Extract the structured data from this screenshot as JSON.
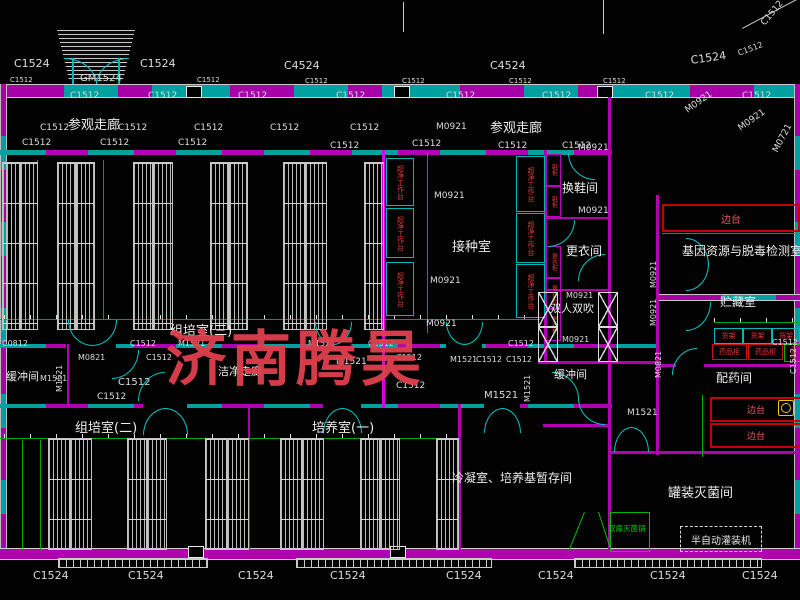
{
  "watermark": {
    "text": "济南腾昊",
    "color": "#e0404e"
  },
  "rooms": {
    "visitor_corridor_left": "参观走廊",
    "visitor_corridor_right": "参观走廊",
    "tissue_culture_3": "组培室(三)",
    "tissue_culture_2": "组培室(二)",
    "culture_1": "培养室(一)",
    "inoculation": "接种室",
    "shoe_change": "换鞋间",
    "clothes_change": "更衣间",
    "air_shower": "双人双吹",
    "gene_lab": "基因资源与脱毒检测室",
    "storage": "贮藏室",
    "dispensary": "配药间",
    "buffer_left": "缓冲间",
    "buffer_right": "缓冲间",
    "clean_corridor": "洁净走廊",
    "condensation": "冷凝室、培养基暂存间",
    "canning": "罐装灭菌间"
  },
  "equipment": {
    "clean_bench": "超净工作台",
    "shoe_cabinet": "鞋柜",
    "clothes_cabinet": "更衣柜",
    "shelf_rack": "货架",
    "medicine_cabinet": "药品柜",
    "sterilizer_pot": "灭菌锅",
    "side_bench": "边台",
    "double_door_sterilizer": "双扉灭菌锅",
    "filling_machine": "半自动灌装机"
  },
  "colors": {
    "wall_magenta": "#b000b0",
    "window_cyan": "#00a0a0",
    "dimension_green": "#00a800",
    "equipment_red": "#d02020",
    "watermark_red": "#e0404e",
    "line_white": "#d0d0d0"
  },
  "annotations": [
    {
      "t": "C1524",
      "x": 14,
      "y": 58,
      "s": 11
    },
    {
      "t": "GM1524",
      "x": 80,
      "y": 74,
      "s": 10
    },
    {
      "t": "C1524",
      "x": 140,
      "y": 58,
      "s": 11
    },
    {
      "t": "C4524",
      "x": 284,
      "y": 60,
      "s": 11
    },
    {
      "t": "C4524",
      "x": 490,
      "y": 60,
      "s": 11
    },
    {
      "t": "C1524",
      "x": 690,
      "y": 55,
      "s": 11,
      "r": -8
    },
    {
      "t": "C1512",
      "x": 737,
      "y": 50,
      "s": 8,
      "r": -20
    },
    {
      "t": "C1512",
      "x": 760,
      "y": 22,
      "s": 9,
      "r": -50
    },
    {
      "t": "C1512",
      "x": 10,
      "y": 77,
      "s": 7
    },
    {
      "t": "C1512",
      "x": 197,
      "y": 77,
      "s": 7
    },
    {
      "t": "C1512",
      "x": 305,
      "y": 78,
      "s": 7
    },
    {
      "t": "C1512",
      "x": 402,
      "y": 78,
      "s": 7
    },
    {
      "t": "C1512",
      "x": 509,
      "y": 78,
      "s": 7
    },
    {
      "t": "C1512",
      "x": 603,
      "y": 78,
      "s": 7
    },
    {
      "t": "C1512",
      "x": 70,
      "y": 92,
      "s": 9
    },
    {
      "t": "C1512",
      "x": 148,
      "y": 92,
      "s": 9
    },
    {
      "t": "C1512",
      "x": 238,
      "y": 92,
      "s": 9
    },
    {
      "t": "C1512",
      "x": 336,
      "y": 92,
      "s": 9
    },
    {
      "t": "C1512",
      "x": 446,
      "y": 92,
      "s": 9
    },
    {
      "t": "C1512",
      "x": 542,
      "y": 92,
      "s": 9
    },
    {
      "t": "C1512",
      "x": 645,
      "y": 92,
      "s": 9
    },
    {
      "t": "C1512",
      "x": 742,
      "y": 92,
      "s": 9
    },
    {
      "t": "C1512",
      "x": 40,
      "y": 124,
      "s": 9
    },
    {
      "t": "C1512",
      "x": 118,
      "y": 124,
      "s": 9
    },
    {
      "t": "C1512",
      "x": 194,
      "y": 124,
      "s": 9
    },
    {
      "t": "C1512",
      "x": 270,
      "y": 124,
      "s": 9
    },
    {
      "t": "C1512",
      "x": 350,
      "y": 124,
      "s": 9
    },
    {
      "t": "M0921",
      "x": 436,
      "y": 123,
      "s": 9
    },
    {
      "t": "C1512",
      "x": 22,
      "y": 139,
      "s": 9
    },
    {
      "t": "C1512",
      "x": 100,
      "y": 139,
      "s": 9
    },
    {
      "t": "C1512",
      "x": 178,
      "y": 139,
      "s": 9
    },
    {
      "t": "C1512",
      "x": 330,
      "y": 142,
      "s": 9
    },
    {
      "t": "C1512",
      "x": 412,
      "y": 140,
      "s": 9
    },
    {
      "t": "C1512",
      "x": 498,
      "y": 142,
      "s": 9
    },
    {
      "t": "C1512",
      "x": 562,
      "y": 142,
      "s": 9
    },
    {
      "t": "M0921",
      "x": 578,
      "y": 144,
      "s": 9
    },
    {
      "t": "M0921",
      "x": 578,
      "y": 207,
      "s": 9
    },
    {
      "t": "M0921",
      "x": 684,
      "y": 108,
      "r": -35,
      "s": 9
    },
    {
      "t": "M0921",
      "x": 737,
      "y": 126,
      "r": -35,
      "s": 9
    },
    {
      "t": "M0721",
      "x": 772,
      "y": 150,
      "r": -62,
      "s": 9
    },
    {
      "t": "M0921",
      "x": 434,
      "y": 192,
      "s": 9
    },
    {
      "t": "M0921",
      "x": 430,
      "y": 277,
      "s": 9
    },
    {
      "t": "M0921",
      "x": 426,
      "y": 320,
      "s": 9
    },
    {
      "t": "M0921",
      "x": 650,
      "y": 288,
      "r": -90,
      "s": 8
    },
    {
      "t": "M0921",
      "x": 650,
      "y": 326,
      "r": -90,
      "s": 8
    },
    {
      "t": "M0921",
      "x": 566,
      "y": 292,
      "s": 8
    },
    {
      "t": "M0921",
      "x": 562,
      "y": 336,
      "s": 8
    },
    {
      "t": "M0821",
      "x": 655,
      "y": 378,
      "r": -90,
      "s": 8
    },
    {
      "t": "M1521",
      "x": 627,
      "y": 409,
      "s": 9
    },
    {
      "t": "C0812",
      "x": 2,
      "y": 340,
      "s": 8
    },
    {
      "t": "C1512",
      "x": 130,
      "y": 340,
      "s": 8
    },
    {
      "t": "M1521",
      "x": 178,
      "y": 340,
      "s": 8
    },
    {
      "t": "M0821",
      "x": 78,
      "y": 354,
      "s": 8
    },
    {
      "t": "M1521",
      "x": 56,
      "y": 392,
      "r": -90,
      "s": 8
    },
    {
      "t": "M1521",
      "x": 40,
      "y": 375,
      "s": 8
    },
    {
      "t": "C1512",
      "x": 146,
      "y": 354,
      "s": 8
    },
    {
      "t": "C1512",
      "x": 118,
      "y": 378,
      "s": 10
    },
    {
      "t": "C1512",
      "x": 97,
      "y": 393,
      "s": 9
    },
    {
      "t": "M1521",
      "x": 308,
      "y": 340,
      "s": 8
    },
    {
      "t": "C1512",
      "x": 368,
      "y": 340,
      "s": 8
    },
    {
      "t": "C1512",
      "x": 508,
      "y": 340,
      "s": 8
    },
    {
      "t": "C1512",
      "x": 772,
      "y": 339,
      "s": 8
    },
    {
      "t": "M1521",
      "x": 336,
      "y": 358,
      "s": 9
    },
    {
      "t": "C1512",
      "x": 396,
      "y": 354,
      "s": 8
    },
    {
      "t": "M1521",
      "x": 450,
      "y": 356,
      "s": 8
    },
    {
      "t": "C1512",
      "x": 476,
      "y": 356,
      "s": 8
    },
    {
      "t": "C1512",
      "x": 506,
      "y": 356,
      "s": 8
    },
    {
      "t": "C1512",
      "x": 396,
      "y": 382,
      "s": 9
    },
    {
      "t": "M1521",
      "x": 484,
      "y": 391,
      "s": 10
    },
    {
      "t": "M1521",
      "x": 524,
      "y": 402,
      "r": -90,
      "s": 8
    },
    {
      "t": "C1512",
      "x": 790,
      "y": 374,
      "r": -90,
      "s": 8
    },
    {
      "t": "C1524",
      "x": 33,
      "y": 570,
      "s": 11
    },
    {
      "t": "C1524",
      "x": 128,
      "y": 570,
      "s": 11
    },
    {
      "t": "C1524",
      "x": 238,
      "y": 570,
      "s": 11
    },
    {
      "t": "C1524",
      "x": 330,
      "y": 570,
      "s": 11
    },
    {
      "t": "C1524",
      "x": 446,
      "y": 570,
      "s": 11
    },
    {
      "t": "C1524",
      "x": 538,
      "y": 570,
      "s": 11
    },
    {
      "t": "C1524",
      "x": 650,
      "y": 570,
      "s": 11
    },
    {
      "t": "C1524",
      "x": 742,
      "y": 570,
      "s": 11
    }
  ]
}
